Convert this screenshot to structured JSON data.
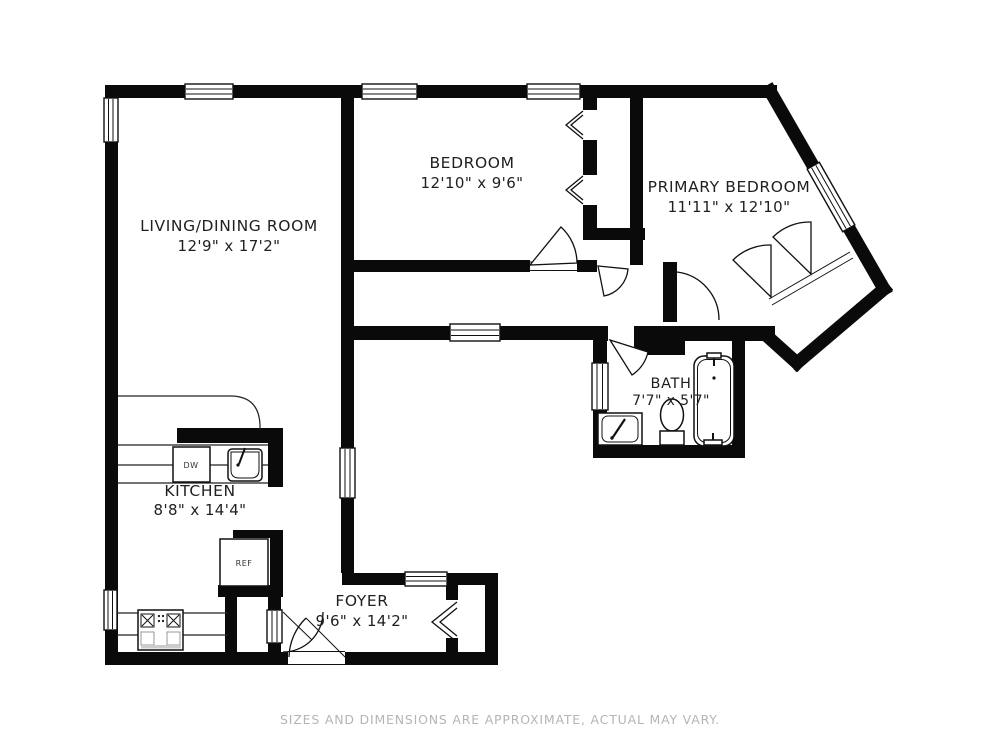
{
  "colors": {
    "wall": "#0a0a0a",
    "background": "#ffffff",
    "label": "#1f1f1f",
    "muted": "#b5b5b5"
  },
  "rooms": [
    {
      "id": "living",
      "name": "LIVING/DINING ROOM",
      "dims": "12'9\" x 17'2\""
    },
    {
      "id": "bedroom",
      "name": "BEDROOM",
      "dims": "12'10\" x 9'6\""
    },
    {
      "id": "primary",
      "name": "PRIMARY BEDROOM",
      "dims": "11'11\" x 12'10\""
    },
    {
      "id": "bath",
      "name": "BATH",
      "dims": "7'7\" x 5'7\""
    },
    {
      "id": "kitchen",
      "name": "KITCHEN",
      "dims": "8'8\" x 14'4\""
    },
    {
      "id": "foyer",
      "name": "FOYER",
      "dims": "9'6\" x 14'2\""
    }
  ],
  "appliances": {
    "dishwasher": "DW",
    "refrigerator": "REF"
  },
  "footer": {
    "text": "SIZES AND DIMENSIONS ARE APPROXIMATE, ACTUAL MAY VARY."
  }
}
